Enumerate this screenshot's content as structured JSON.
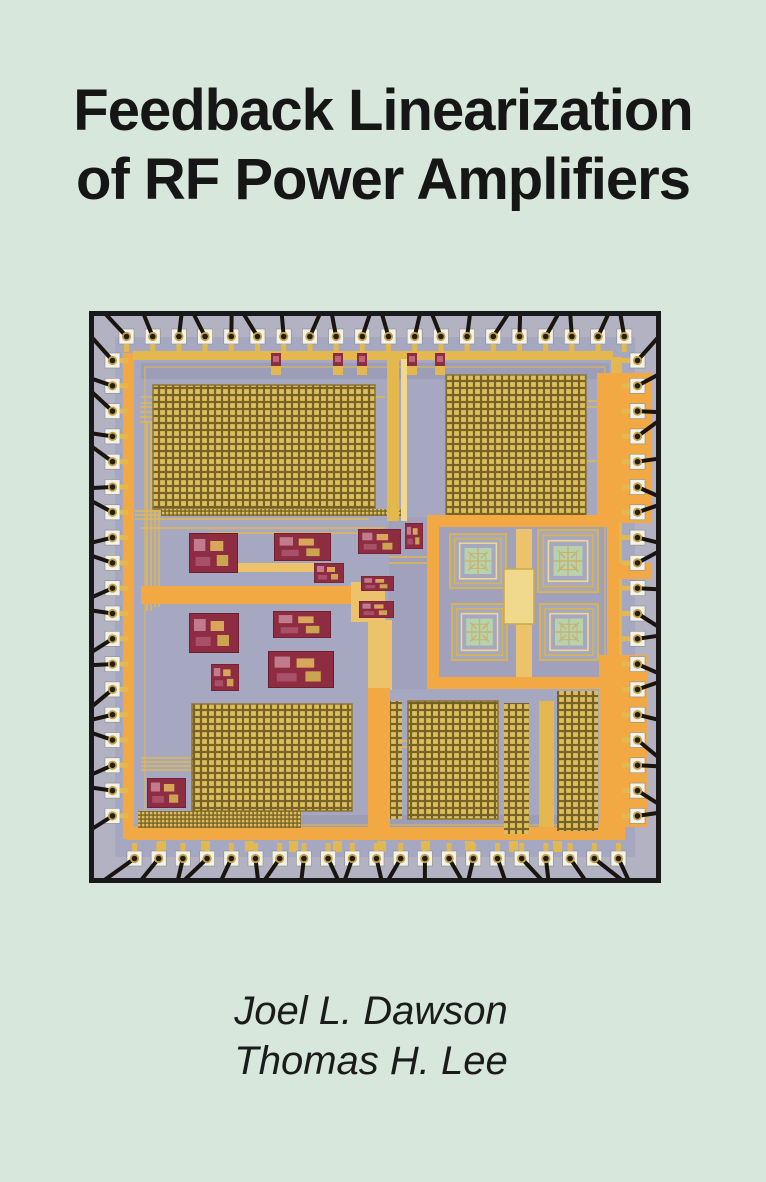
{
  "page": {
    "width": 766,
    "height": 1182,
    "background_color": "#d7e7dc"
  },
  "title": {
    "line1": "Feedback Linearization",
    "line2": "of RF Power Amplifiers",
    "color": "#161616"
  },
  "authors": {
    "line1": "Joel L. Dawson",
    "line2": "Thomas H. Lee",
    "color": "#1b1b1b"
  },
  "die_photo": {
    "description": "Color micrograph of an RF power-amplifier CMOS die: white bond pads with black bond wires around the periphery, large gold capacitor arrays top and bottom, four square spiral inductors with pale-green centers at middle right, orange power routing buses and small dark-red circuit blocks on a lavender substrate, framed in black",
    "pads": {
      "top": 20,
      "bottom": 21,
      "left": 19,
      "right": 19
    },
    "colors": {
      "frame": "#191919",
      "margin": "#b2b2c3",
      "substrate": "#a6a7c0",
      "substrate_dark": "#9c9db7",
      "pad": "#f3f2e9",
      "gold": "#e2b84f",
      "pale_gold": "#f0d98c",
      "orange": "#f2a843",
      "tan": "#ecc36a",
      "capacitor_fill": "#dcbd60",
      "capacitor_line": "#786325",
      "inductor_green": "#b7d2ad",
      "circuit_red": "#8e2c42",
      "bond_wire": "#19140d"
    }
  }
}
